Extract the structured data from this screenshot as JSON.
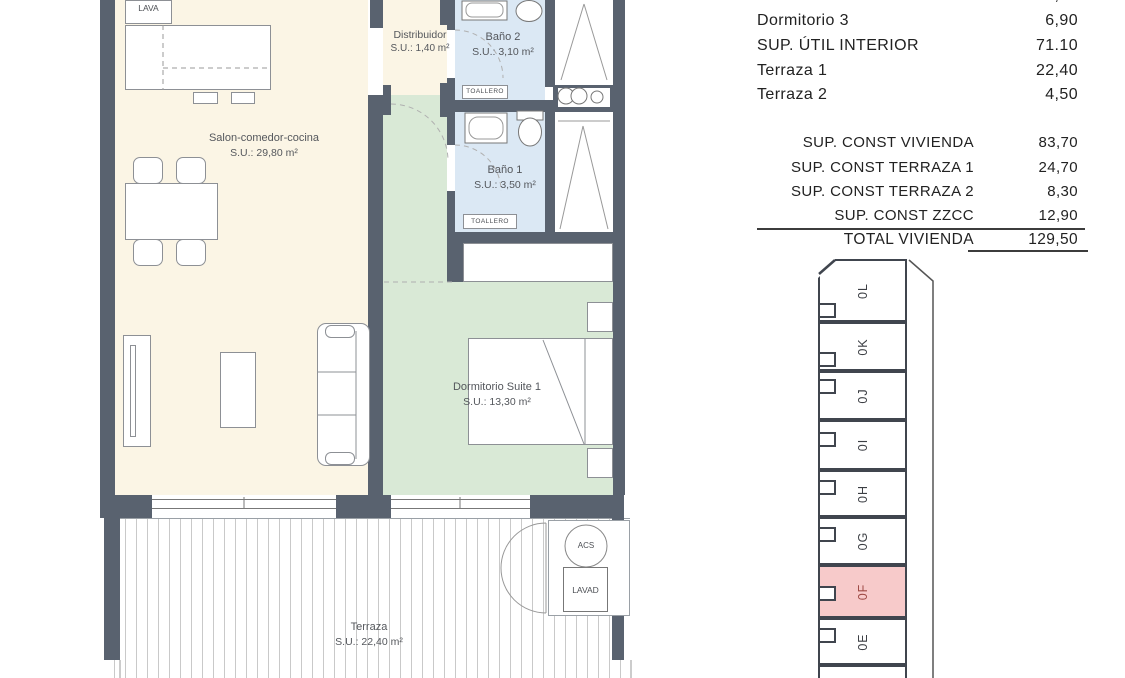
{
  "floor_plan": {
    "rooms": [
      {
        "label": "Salon-comedor-cocina",
        "area": "S.U.: 29,80 m²"
      },
      {
        "label": "Distribuidor",
        "area": "S.U.: 1,40 m²"
      },
      {
        "label": "Baño 2",
        "area": "S.U.: 3,10 m²"
      },
      {
        "label": "Baño 1",
        "area": "S.U.: 3,50 m²"
      },
      {
        "label": "Dormitorio Suite 1",
        "area": "S.U.: 13,30 m²"
      },
      {
        "label": "Terraza",
        "area": "S.U.: 22,40 m²"
      }
    ],
    "fixtures": {
      "lava": "LAVA",
      "toallero": "TOALLERO",
      "acs": "ACS",
      "lavad": "LAVAD"
    },
    "colors": {
      "wall": "#59626f",
      "salon": "#fbf5e5",
      "bath": "#dbe8f4",
      "bedroom": "#d9e9d6"
    }
  },
  "areas_table": {
    "rows": [
      {
        "label": "Dormitorio 2",
        "value": "11,60"
      },
      {
        "label": "Dormitorio 3",
        "value": "6,90"
      },
      {
        "label": "SUP. ÚTIL INTERIOR",
        "value": "71.10"
      },
      {
        "label": "Terraza 1",
        "value": "22,40"
      },
      {
        "label": "Terraza 2",
        "value": "4,50"
      }
    ],
    "const_rows": [
      {
        "label": "SUP. CONST VIVIENDA",
        "value": "83,70"
      },
      {
        "label": "SUP. CONST TERRAZA 1",
        "value": "24,70"
      },
      {
        "label": "SUP. CONST TERRAZA 2",
        "value": "8,30"
      },
      {
        "label": "SUP. CONST ZZCC",
        "value": "12,90"
      }
    ],
    "total_row": {
      "label": "TOTAL VIVIENDA",
      "value": "129,50"
    }
  },
  "key_plan": {
    "units": [
      {
        "id": "0L",
        "highlighted": false
      },
      {
        "id": "0K",
        "highlighted": false
      },
      {
        "id": "0J",
        "highlighted": false
      },
      {
        "id": "0I",
        "highlighted": false
      },
      {
        "id": "0H",
        "highlighted": false
      },
      {
        "id": "0G",
        "highlighted": false
      },
      {
        "id": "0F",
        "highlighted": true
      },
      {
        "id": "0E",
        "highlighted": false
      }
    ],
    "highlight_color": "#f7caca",
    "highlight_text_color": "#9e4a45"
  }
}
